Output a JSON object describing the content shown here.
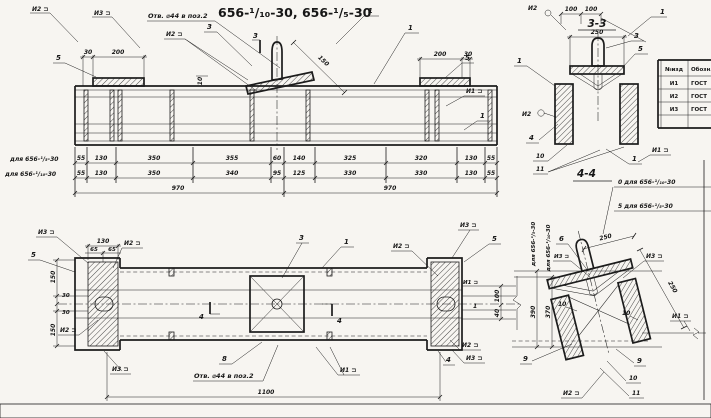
{
  "title": "656-¹/₁₀-30, 656-¹/₅-30",
  "hole_note": "Отв. ⌀44 в поз.2",
  "sections": {
    "s33": "3-3",
    "s44": "4-4"
  },
  "markers": {
    "i1": "И1 ⊐",
    "i2": "И2 ⊐",
    "i3": "И3 ⊐",
    "i2_plain": "И2"
  },
  "callouts": {
    "n1": "1",
    "n3": "3",
    "n4": "4",
    "n5": "5",
    "n6": "6",
    "n8": "8",
    "n9": "9",
    "n10": "10",
    "n11": "11"
  },
  "dims": {
    "d30": "30",
    "d200": "200",
    "d10": "10",
    "d150": "150",
    "d65": "65",
    "d130": "130",
    "d100": "100",
    "d40": "40",
    "d970": "970",
    "d1100": "1100",
    "d250": "250",
    "d390": "390",
    "d370": "370"
  },
  "dim_rows": {
    "row1": {
      "label": "для 656-¹/₅-30",
      "values": [
        "55",
        "130",
        "350",
        "355",
        "60",
        "140",
        "325",
        "320",
        "130",
        "55"
      ]
    },
    "row2": {
      "label": "для 656-¹/₁₀-30",
      "values": [
        "55",
        "130",
        "350",
        "340",
        "95",
        "125",
        "330",
        "330",
        "130",
        "55"
      ]
    },
    "total_left": "970",
    "total_right": "970"
  },
  "variants": {
    "v10_note": "0 для 656-¹/₁₀-30",
    "v5_note": "5 для 656-¹/₅-30",
    "v5_vert": "для 656-¹/₅-30",
    "v10_vert": "для 656-¹/₁₀-30"
  },
  "table": {
    "c1": "№изд",
    "c2": "Обозн.",
    "r1": "И1",
    "r2": "И2",
    "r3": "И3",
    "doc": "ГОСТ"
  }
}
